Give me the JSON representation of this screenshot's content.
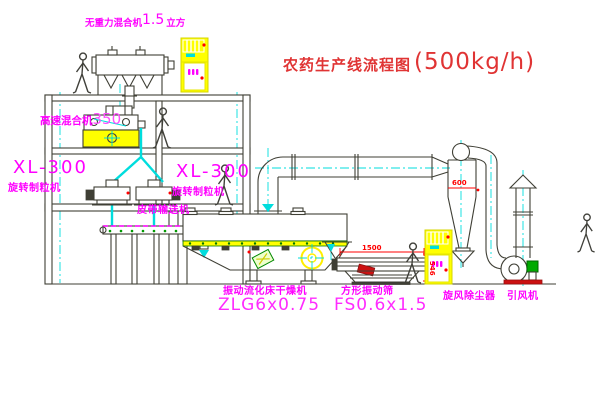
{
  "title": {
    "name": "农药生产线流程图",
    "capacity": "(500kg/h)"
  },
  "labels": {
    "gravity_free_mixer_name": "无重力混合机",
    "gravity_free_mixer_volume": "1.5",
    "gravity_free_mixer_unit": "立方",
    "high_speed_mixer_name": "高速混合机",
    "high_speed_mixer_model": "350",
    "granulator_left_model": "XL-300",
    "granulator_left_name": "旋转制粒机",
    "granulator_center_model": "XL-300",
    "granulator_center_name": "旋转制粒机",
    "belt_conveyor": "皮带输送机",
    "dryer_name": "振动流化床干燥机",
    "dryer_model": "ZLG6x0.75",
    "sieve_name": "方形振动筛",
    "sieve_model": "FS0.6x1.5",
    "cyclone": "旋风除尘器",
    "fan": "引风机"
  },
  "dimensions": {
    "cyclone_body": "600",
    "sieve_length": "1500",
    "sieve_height": "546"
  },
  "colors": {
    "label_magenta": "#ff00ff",
    "title_red": "#e03434",
    "dimension_red": "#ff0000",
    "machine_yellow": "#ffff00",
    "centerline_cyan": "#00dddd",
    "structure_line": "#3f3f35",
    "motor_green": "#00aa00"
  }
}
